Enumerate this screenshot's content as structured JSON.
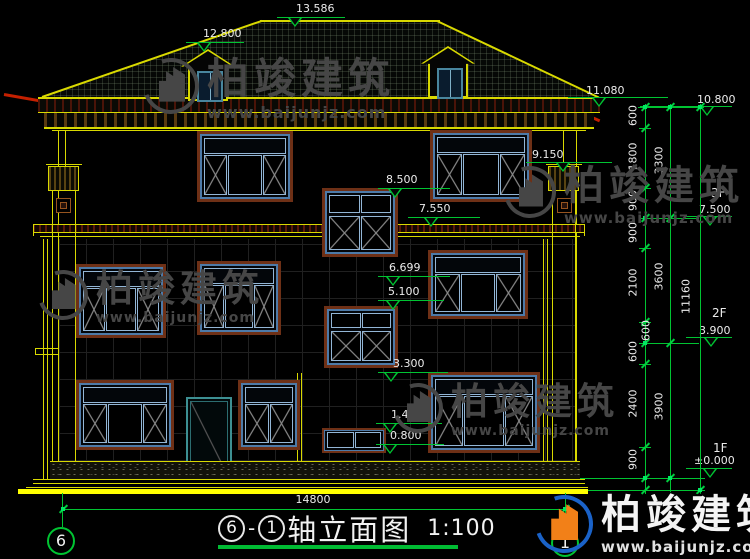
{
  "watermark": {
    "brand": "柏竣建筑",
    "url": "www.baijunjz.com"
  },
  "levels": {
    "ridge": "13.586",
    "dormer": "12.800",
    "eave": "11.080",
    "roof_top": "10.800",
    "capital": "9.150",
    "stair_top": "8.500",
    "band": "7.550",
    "stair_bottom": "6.699",
    "stair2_top": "5.100",
    "stair2_bottom": "3.300",
    "landing_top": "1.400",
    "landing_bottom": "0.800"
  },
  "floors": {
    "f3_label": "3F",
    "f3_elev": "7.500",
    "f2_label": "2F",
    "f2_elev": "3.900",
    "f1_label": "1F",
    "f1_elev": "±0.000"
  },
  "dims": {
    "col1": [
      "600",
      "1800",
      "900",
      "900",
      "2100",
      "600",
      "600",
      "2400",
      "900"
    ],
    "col2": [
      "3300",
      "3600",
      "3900"
    ],
    "col3": "11160",
    "width": "14800"
  },
  "axes": {
    "left": "6",
    "right": "1"
  },
  "title": {
    "axis_left": "6",
    "separator": "-",
    "axis_right": "1",
    "name": "轴立面图",
    "scale": "1:100"
  }
}
